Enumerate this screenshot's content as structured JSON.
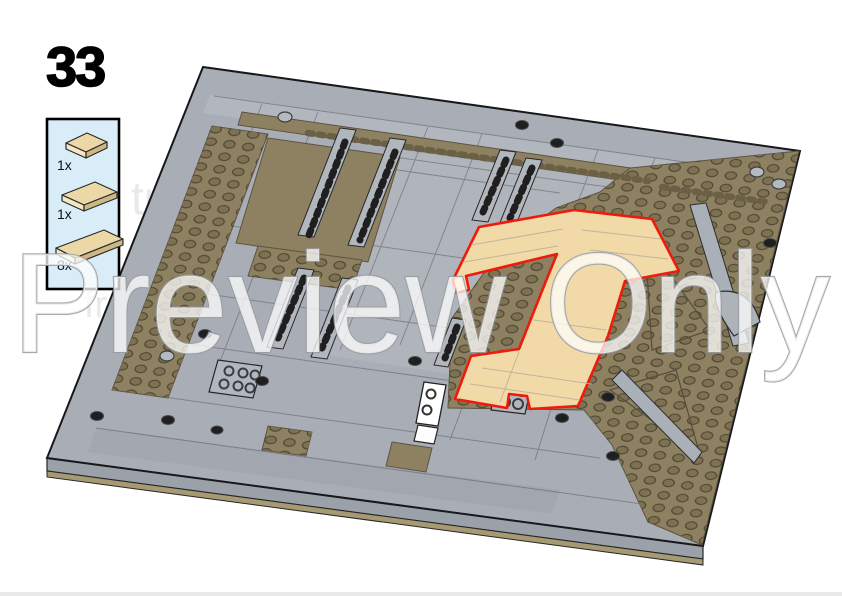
{
  "page": {
    "background_color": "#ffffff",
    "footer_bar_color": "#e8e8e8"
  },
  "step": {
    "number": "33"
  },
  "parts_callout": {
    "background_color": "#d9edf8",
    "border_color": "#000000",
    "parts": [
      {
        "quantity": "1x",
        "icon": "tan-plate-small-icon",
        "color": "#ecd8a6"
      },
      {
        "quantity": "1x",
        "icon": "tan-plate-medium-icon",
        "color": "#ecd8a6"
      },
      {
        "quantity": "8x",
        "icon": "tan-plate-large-icon",
        "color": "#ecd8a6"
      }
    ]
  },
  "model": {
    "colors": {
      "base_gray": "#a9aeb6",
      "light_gray": "#b7bcc3",
      "dark_tan": "#8e8161",
      "stud_tan": "#7d7152",
      "edge_tan": "#a79a73",
      "side_gray": "#9ba1a9",
      "highlight_fill": "#f1daa7",
      "highlight_outline": "#ee1b0d"
    }
  },
  "watermark": {
    "text": "Preview Only",
    "fragments": [
      {
        "text": "tr"
      },
      {
        "text": "fro"
      }
    ]
  }
}
